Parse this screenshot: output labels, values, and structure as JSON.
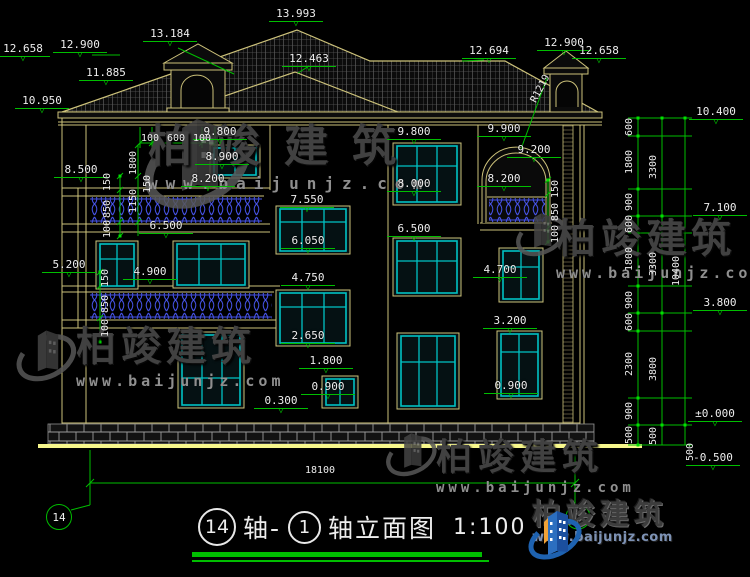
{
  "watermark": {
    "brand": "柏竣建筑",
    "url": "www.baijunjz.com"
  },
  "brand_logo": {
    "brand": "柏竣建筑",
    "url": "www.baijunjz.com"
  },
  "title_block": {
    "axis_left": "14",
    "joiner": "轴-",
    "axis_right": "1",
    "name": "轴立面图",
    "scale": "1:100"
  },
  "axis_bubbles": {
    "left": "14",
    "right": "1"
  },
  "colors": {
    "wall": "#CDC27A",
    "window": "#00C2C4",
    "railing": "#4653E8",
    "dimension": "#00BE00",
    "ground": "#F7F78C",
    "text": "#EDEDED"
  },
  "levels": [
    {
      "id": "L13993",
      "text": "13.993"
    },
    {
      "id": "L13184",
      "text": "13.184"
    },
    {
      "id": "L12900a",
      "text": "12.900"
    },
    {
      "id": "L12658a",
      "text": "12.658"
    },
    {
      "id": "L11885",
      "text": "11.885"
    },
    {
      "id": "L10950",
      "text": "10.950"
    },
    {
      "id": "L12463",
      "text": "12.463"
    },
    {
      "id": "L12694",
      "text": "12.694"
    },
    {
      "id": "L12900b",
      "text": "12.900"
    },
    {
      "id": "L12658b",
      "text": "12.658"
    },
    {
      "id": "L10400",
      "text": "10.400"
    },
    {
      "id": "L9800a",
      "text": "9.800"
    },
    {
      "id": "L9800b",
      "text": "9.800"
    },
    {
      "id": "L9900",
      "text": "9.900"
    },
    {
      "id": "L9200",
      "text": "9.200"
    },
    {
      "id": "L8900",
      "text": "8.900"
    },
    {
      "id": "L8500",
      "text": "8.500"
    },
    {
      "id": "L8200a",
      "text": "8.200"
    },
    {
      "id": "L8200b",
      "text": "8.200"
    },
    {
      "id": "L8000",
      "text": "8.000"
    },
    {
      "id": "L7550",
      "text": "7.550"
    },
    {
      "id": "L7100",
      "text": "7.100"
    },
    {
      "id": "L6500a",
      "text": "6.500"
    },
    {
      "id": "L6500b",
      "text": "6.500"
    },
    {
      "id": "L6050",
      "text": "6.050"
    },
    {
      "id": "L5200",
      "text": "5.200"
    },
    {
      "id": "L4900",
      "text": "4.900"
    },
    {
      "id": "L4750",
      "text": "4.750"
    },
    {
      "id": "L4700",
      "text": "4.700"
    },
    {
      "id": "L3800",
      "text": "3.800"
    },
    {
      "id": "L3200",
      "text": "3.200"
    },
    {
      "id": "L2650",
      "text": "2.650"
    },
    {
      "id": "L1800",
      "text": "1.800"
    },
    {
      "id": "L0900a",
      "text": "0.900"
    },
    {
      "id": "L0900b",
      "text": "0.900"
    },
    {
      "id": "L0300",
      "text": "0.300"
    },
    {
      "id": "L0000",
      "text": "±0.000"
    },
    {
      "id": "Lm0500",
      "text": "-0.500"
    }
  ],
  "dim_labels": [
    {
      "id": "d-100a",
      "text": "100"
    },
    {
      "id": "d-600a",
      "text": "600"
    },
    {
      "id": "d-100b",
      "text": "100"
    },
    {
      "id": "d-150a",
      "text": "150"
    },
    {
      "id": "d-850a",
      "text": "850"
    },
    {
      "id": "d-100c",
      "text": "100"
    },
    {
      "id": "d-1800a",
      "text": "1800"
    },
    {
      "id": "d-1150",
      "text": "1150"
    },
    {
      "id": "d-150b",
      "text": "150"
    },
    {
      "id": "d-150c",
      "text": "150"
    },
    {
      "id": "d-850b",
      "text": "850"
    },
    {
      "id": "d-100d",
      "text": "100"
    },
    {
      "id": "d-150d",
      "text": "150"
    },
    {
      "id": "d-850c",
      "text": "850"
    },
    {
      "id": "d-100e",
      "text": "100"
    },
    {
      "id": "c1-600a",
      "text": "600"
    },
    {
      "id": "c1-1800a",
      "text": "1800"
    },
    {
      "id": "c1-900a",
      "text": "900"
    },
    {
      "id": "c1-600b",
      "text": "600"
    },
    {
      "id": "c1-1800b",
      "text": "1800"
    },
    {
      "id": "c1-900b",
      "text": "900"
    },
    {
      "id": "c1-600c",
      "text": "600"
    },
    {
      "id": "c1-2300",
      "text": "2300"
    },
    {
      "id": "c1-900c",
      "text": "900"
    },
    {
      "id": "c1-500a",
      "text": "500"
    },
    {
      "id": "c2-3300a",
      "text": "3300"
    },
    {
      "id": "c2-3300b",
      "text": "3300"
    },
    {
      "id": "c2-3800",
      "text": "3800"
    },
    {
      "id": "c2-500",
      "text": "500"
    },
    {
      "id": "c3-10400",
      "text": "10400"
    },
    {
      "id": "c3-500",
      "text": "500"
    },
    {
      "id": "d-18100",
      "text": "18100"
    },
    {
      "id": "d-r1219",
      "text": "R1219"
    }
  ]
}
